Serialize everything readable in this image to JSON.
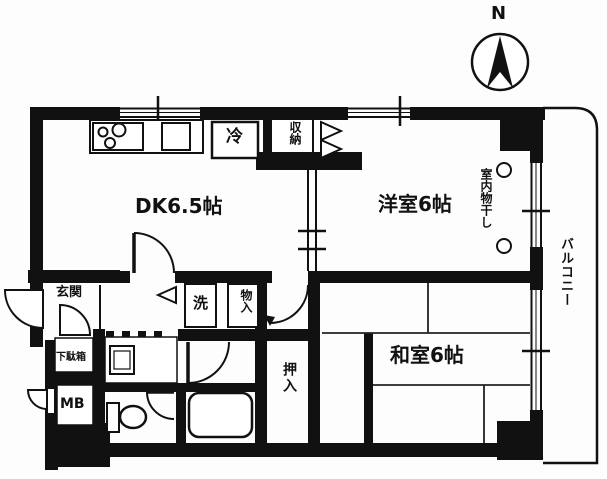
{
  "title": "apartment-floor-plan",
  "compass": {
    "label": "N"
  },
  "rooms": {
    "dining_kitchen": "DK6.5帖",
    "western_room": "洋室6帖",
    "japanese_room": "和室6帖",
    "entrance": "玄関",
    "balcony": "バルコニー"
  },
  "fixtures": {
    "refrigerator": "冷",
    "storage_top": "収納",
    "storage_hall": "物入",
    "washer": "洗",
    "futon_closet": "押入",
    "shoe_cabinet": "下駄箱",
    "meter_box": "MB",
    "indoor_drying": "室内物干し"
  },
  "colors": {
    "wall": "#111111",
    "background": "#ffffff",
    "line": "#222222"
  }
}
